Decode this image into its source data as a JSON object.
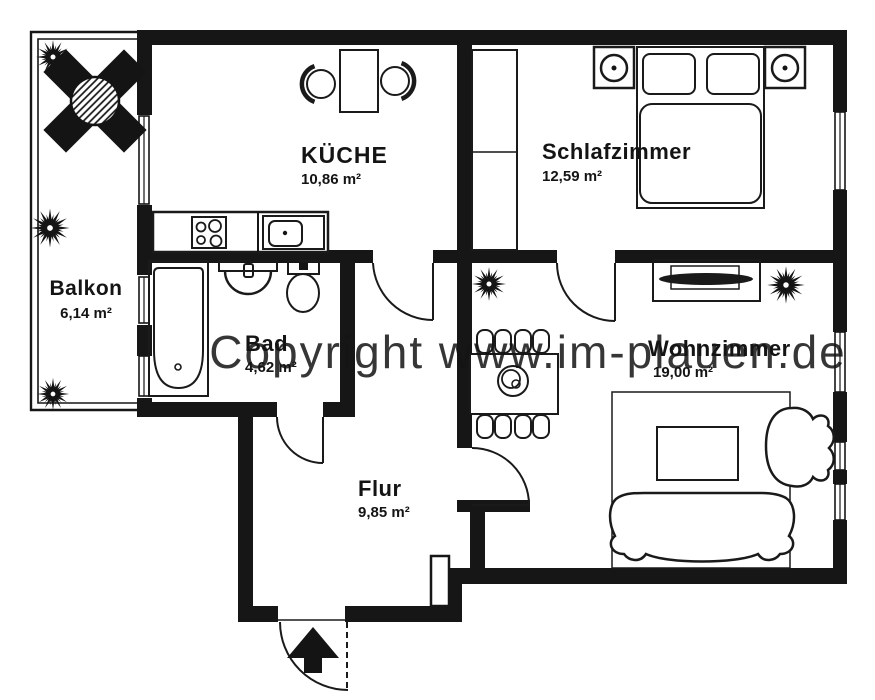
{
  "watermark": {
    "text": "Copyright www.im-plauen.de",
    "color": "#bdbdbd"
  },
  "rooms": [
    {
      "name": "Balkon",
      "area": "6,14 m²"
    },
    {
      "name": "KÜCHE",
      "area": "10,86 m²"
    },
    {
      "name": "Schlafzimmer",
      "area": "12,59 m²"
    },
    {
      "name": "Bad",
      "area": "4,62 m²"
    },
    {
      "name": "Wohnzimmer",
      "area": "19,00 m²"
    },
    {
      "name": "Flur",
      "area": "9,85 m²"
    }
  ],
  "colors": {
    "wall": "#161616",
    "background": "#ffffff",
    "watermark": "#bdbdbd"
  }
}
